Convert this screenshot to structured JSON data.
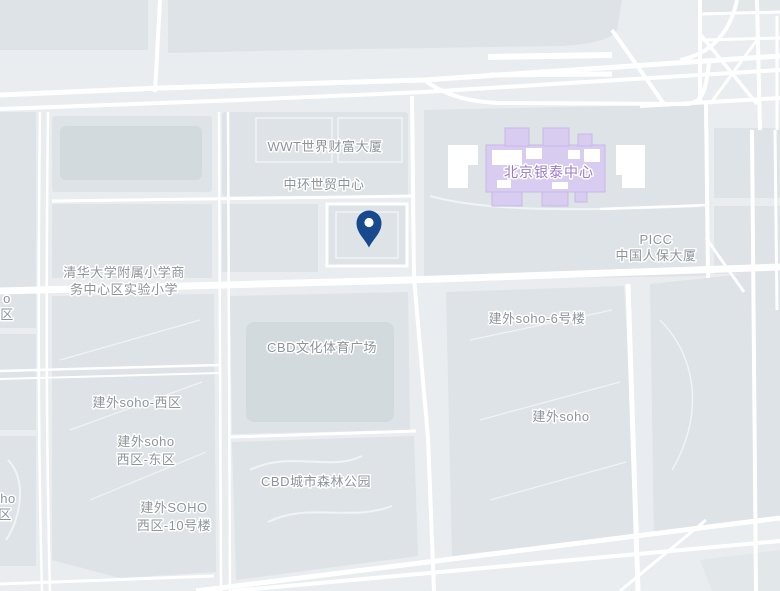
{
  "map": {
    "labels": {
      "wwt_tower": "WWT世界财富大厦",
      "zhonghuan_wtc": "中环世贸中心",
      "yintai_center": "北京银泰中心",
      "picc_1": "PICC",
      "picc_2": "中国人保大厦",
      "school_1": "清华大学附属小学商",
      "school_2": "务中心区实验小学",
      "cbd_sports_plaza": "CBD文化体育广场",
      "jianwai_soho_6": "建外soho-6号楼",
      "jianwai_soho_west": "建外soho-西区",
      "jianwai_soho_we_1": "建外soho",
      "jianwai_soho_we_2": "西区-东区",
      "jianwai_soho": "建外soho",
      "cbd_forest_park": "CBD城市森林公园",
      "jianwai_soho_10_1": "建外SOHO",
      "jianwai_soho_10_2": "西区-10号楼",
      "edge_top_1": "o",
      "edge_top_2": "区",
      "edge_bottom_1": "ho",
      "edge_bottom_2": "区"
    },
    "marker": {
      "name": "location-pin-icon"
    },
    "colors": {
      "background": "#e9edef",
      "block": "#dde3e6",
      "building": "#d2dade",
      "road": "#ffffff",
      "minor_path": "#f1f4f5",
      "label_text": "#8d9599",
      "label_halo": "#ffffff",
      "poi_fill": "#d8ccf1",
      "poi_outline": "#c7b8e9",
      "poi_text": "#9c78d2",
      "pin_fill": "#17498d"
    }
  }
}
